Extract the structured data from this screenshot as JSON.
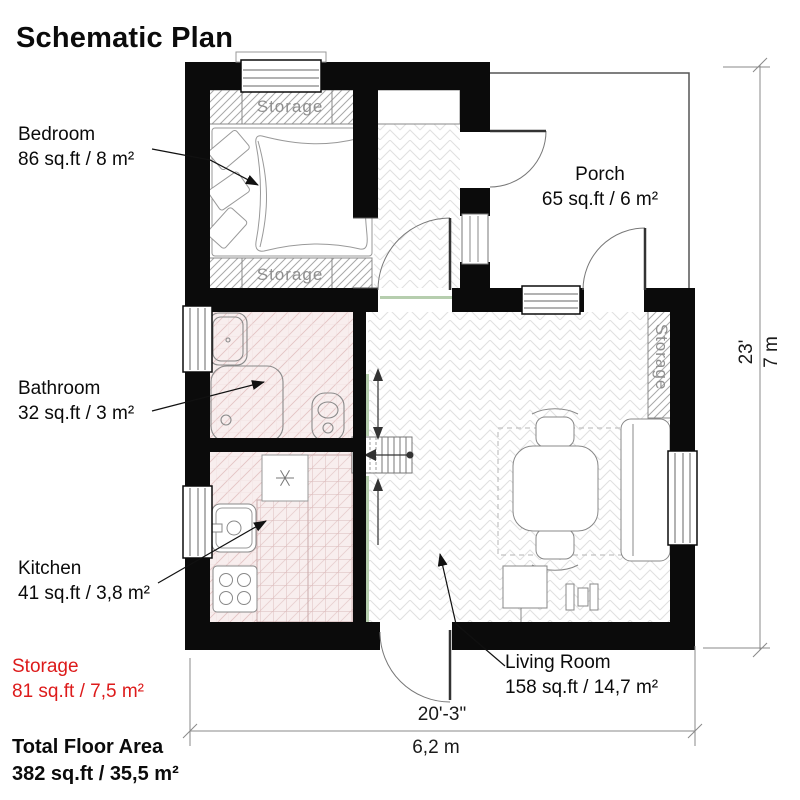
{
  "title": "Schematic Plan",
  "labels": {
    "bedroom": {
      "name": "Bedroom",
      "area": "86 sq.ft / 8 m²"
    },
    "porch": {
      "name": "Porch",
      "area": "65 sq.ft / 6 m²"
    },
    "bathroom": {
      "name": "Bathroom",
      "area": "32 sq.ft / 3 m²"
    },
    "kitchen": {
      "name": "Kitchen",
      "area": "41 sq.ft / 3,8 m²"
    },
    "living_room": {
      "name": "Living Room",
      "area": "158 sq.ft / 14,7 m²"
    },
    "storage": {
      "name": "Storage",
      "area": "81 sq.ft / 7,5 m²"
    }
  },
  "plan_texts": {
    "storage_top": "Storage",
    "storage_bottom": "Storage",
    "storage_side": "Storage"
  },
  "total": {
    "label": "Total Floor Area",
    "value": "382 sq.ft / 35,5 m²"
  },
  "dimensions": {
    "height_ft": "23'",
    "height_m": "7 m",
    "width_ft": "20'-3\"",
    "width_m": "6,2 m"
  },
  "colors": {
    "wall": "#0b0b0b",
    "storage_red": "#dd1b1b",
    "floor_pink": "#f8eeee",
    "pink_hatch_line": "#e3c5c5",
    "storage_hatch_gray": "#a8a8a8",
    "band_text_gray": "#8f8f8f",
    "dim_line_gray": "#8a8a8a",
    "herringbone_gray": "#e0e0e0",
    "accent_green": "#b6ceae"
  }
}
